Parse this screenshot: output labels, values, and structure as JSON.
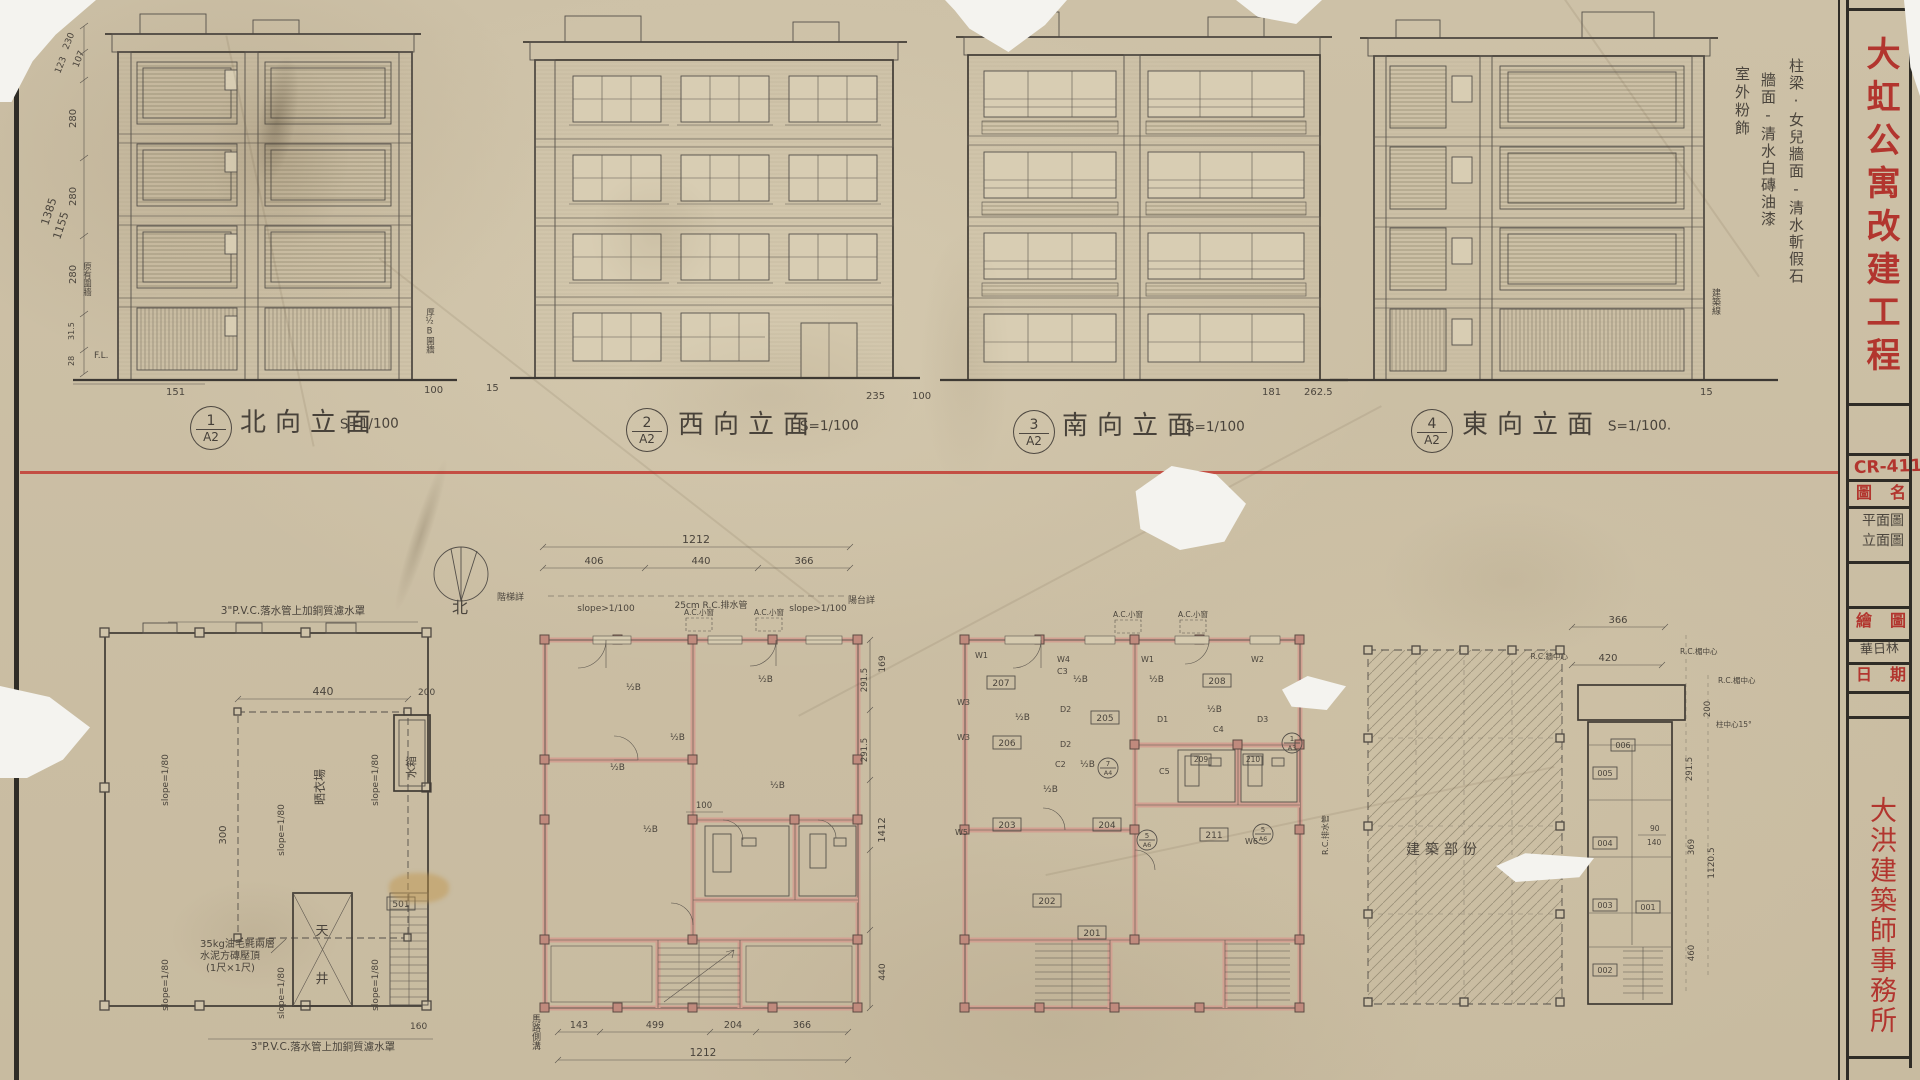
{
  "sheet": {
    "project_title": "大虹公寓改建工程",
    "drawing_no": "CR-411",
    "field_drawing_name": "圖名",
    "drawing_name_1": "平面圖",
    "drawing_name_2": "立面圖",
    "field_drawn": "繪圖",
    "drawn_by": "華日林",
    "field_date": "日期",
    "firm": "大洪建築師事務所"
  },
  "finish_notes": {
    "c1": "柱梁·女兒牆面-清水斬假石",
    "c2": "牆面-清水白磚油漆",
    "c3": "室外粉飾"
  },
  "elevations": [
    {
      "no": "1",
      "sheet": "A2",
      "name": "北向立面",
      "scale": "S=1/100"
    },
    {
      "no": "2",
      "sheet": "A2",
      "name": "西向立面",
      "scale": "S=1/100"
    },
    {
      "no": "3",
      "sheet": "A2",
      "name": "南向立面",
      "scale": "S=1/100"
    },
    {
      "no": "4",
      "sheet": "A2",
      "name": "東向立面",
      "scale": "S=1/100."
    }
  ],
  "site": {
    "building_line": "建築線",
    "old_fence": "原有圍牆",
    "fence": "厚½B圍牆",
    "fl": "F.L."
  },
  "dims": {
    "d151": "151",
    "d100": "100",
    "d15": "15",
    "d235": "235",
    "d100b": "100",
    "d181": "181",
    "d2625": "262.5",
    "d15b": "15",
    "v230": "230",
    "v107": "107",
    "v123": "123",
    "v280": "280",
    "v315": "31.5",
    "v28": "28",
    "t1385": "1385",
    "t1155": "1155"
  },
  "compass": {
    "north": "北"
  },
  "roof": {
    "pvc": "3\"P.V.C.落水管上加銅質濾水罩",
    "slope": "slope=1/80",
    "drying": "晒衣場",
    "tank": "水箱",
    "well_a": "天",
    "well_b": "井",
    "stair": "501",
    "cap1": "35kg油毛氈兩層",
    "cap2": "水泥方磚壓頂",
    "cap3": "(1尺×1尺)",
    "d440": "440",
    "d300": "300",
    "d200": "200",
    "d160": "160"
  },
  "typ": {
    "d1212": "1212",
    "d406": "406",
    "d440": "440",
    "d366": "366",
    "slope": "slope>1/100",
    "pipe": "25cm R.C.排水管",
    "acw": "A.C.小窗",
    "hb": "½B",
    "b143": "143",
    "b499": "499",
    "b204": "204",
    "b366": "366",
    "b1212": "1212",
    "d100": "100",
    "r2915": "291.5",
    "r169": "169",
    "r1412": "1412",
    "r440": "440",
    "road": "馬路側溝",
    "stair_note": "階梯詳",
    "balc_note": "陽台詳"
  },
  "fl2": {
    "n201": "201",
    "n202": "202",
    "n203": "203",
    "n204": "204",
    "n205": "205",
    "n206": "206",
    "n207": "207",
    "n208": "208",
    "n209": "209",
    "n210": "210",
    "n211": "211",
    "w1": "W1",
    "w2": "W2",
    "w3": "W3",
    "w4": "W4",
    "w5": "W5",
    "w6": "W6",
    "dd1": "D1",
    "dd2": "D2",
    "dd3": "D3",
    "c2": "C2",
    "c3": "C3",
    "c4": "C4",
    "c5": "C5",
    "refa_n": "1",
    "refa_s": "A3",
    "refb_n": "7",
    "refb_s": "A4",
    "refc_n": "5",
    "refc_s": "A6",
    "drain": "R.C.排水管"
  },
  "ground": {
    "label": "建築部份",
    "n001": "001",
    "n002": "002",
    "n003": "003",
    "n004": "004",
    "n005": "005",
    "n006": "006",
    "d366": "366",
    "d420": "420",
    "d200": "200",
    "d2915": "291.5",
    "d369": "369",
    "d11205": "1120.5",
    "d460": "460",
    "d90": "90",
    "d140": "140",
    "rc_wall": "R.C.牆中心",
    "rc_beam": "R.C.楣中心",
    "col": "柱中心15°"
  }
}
